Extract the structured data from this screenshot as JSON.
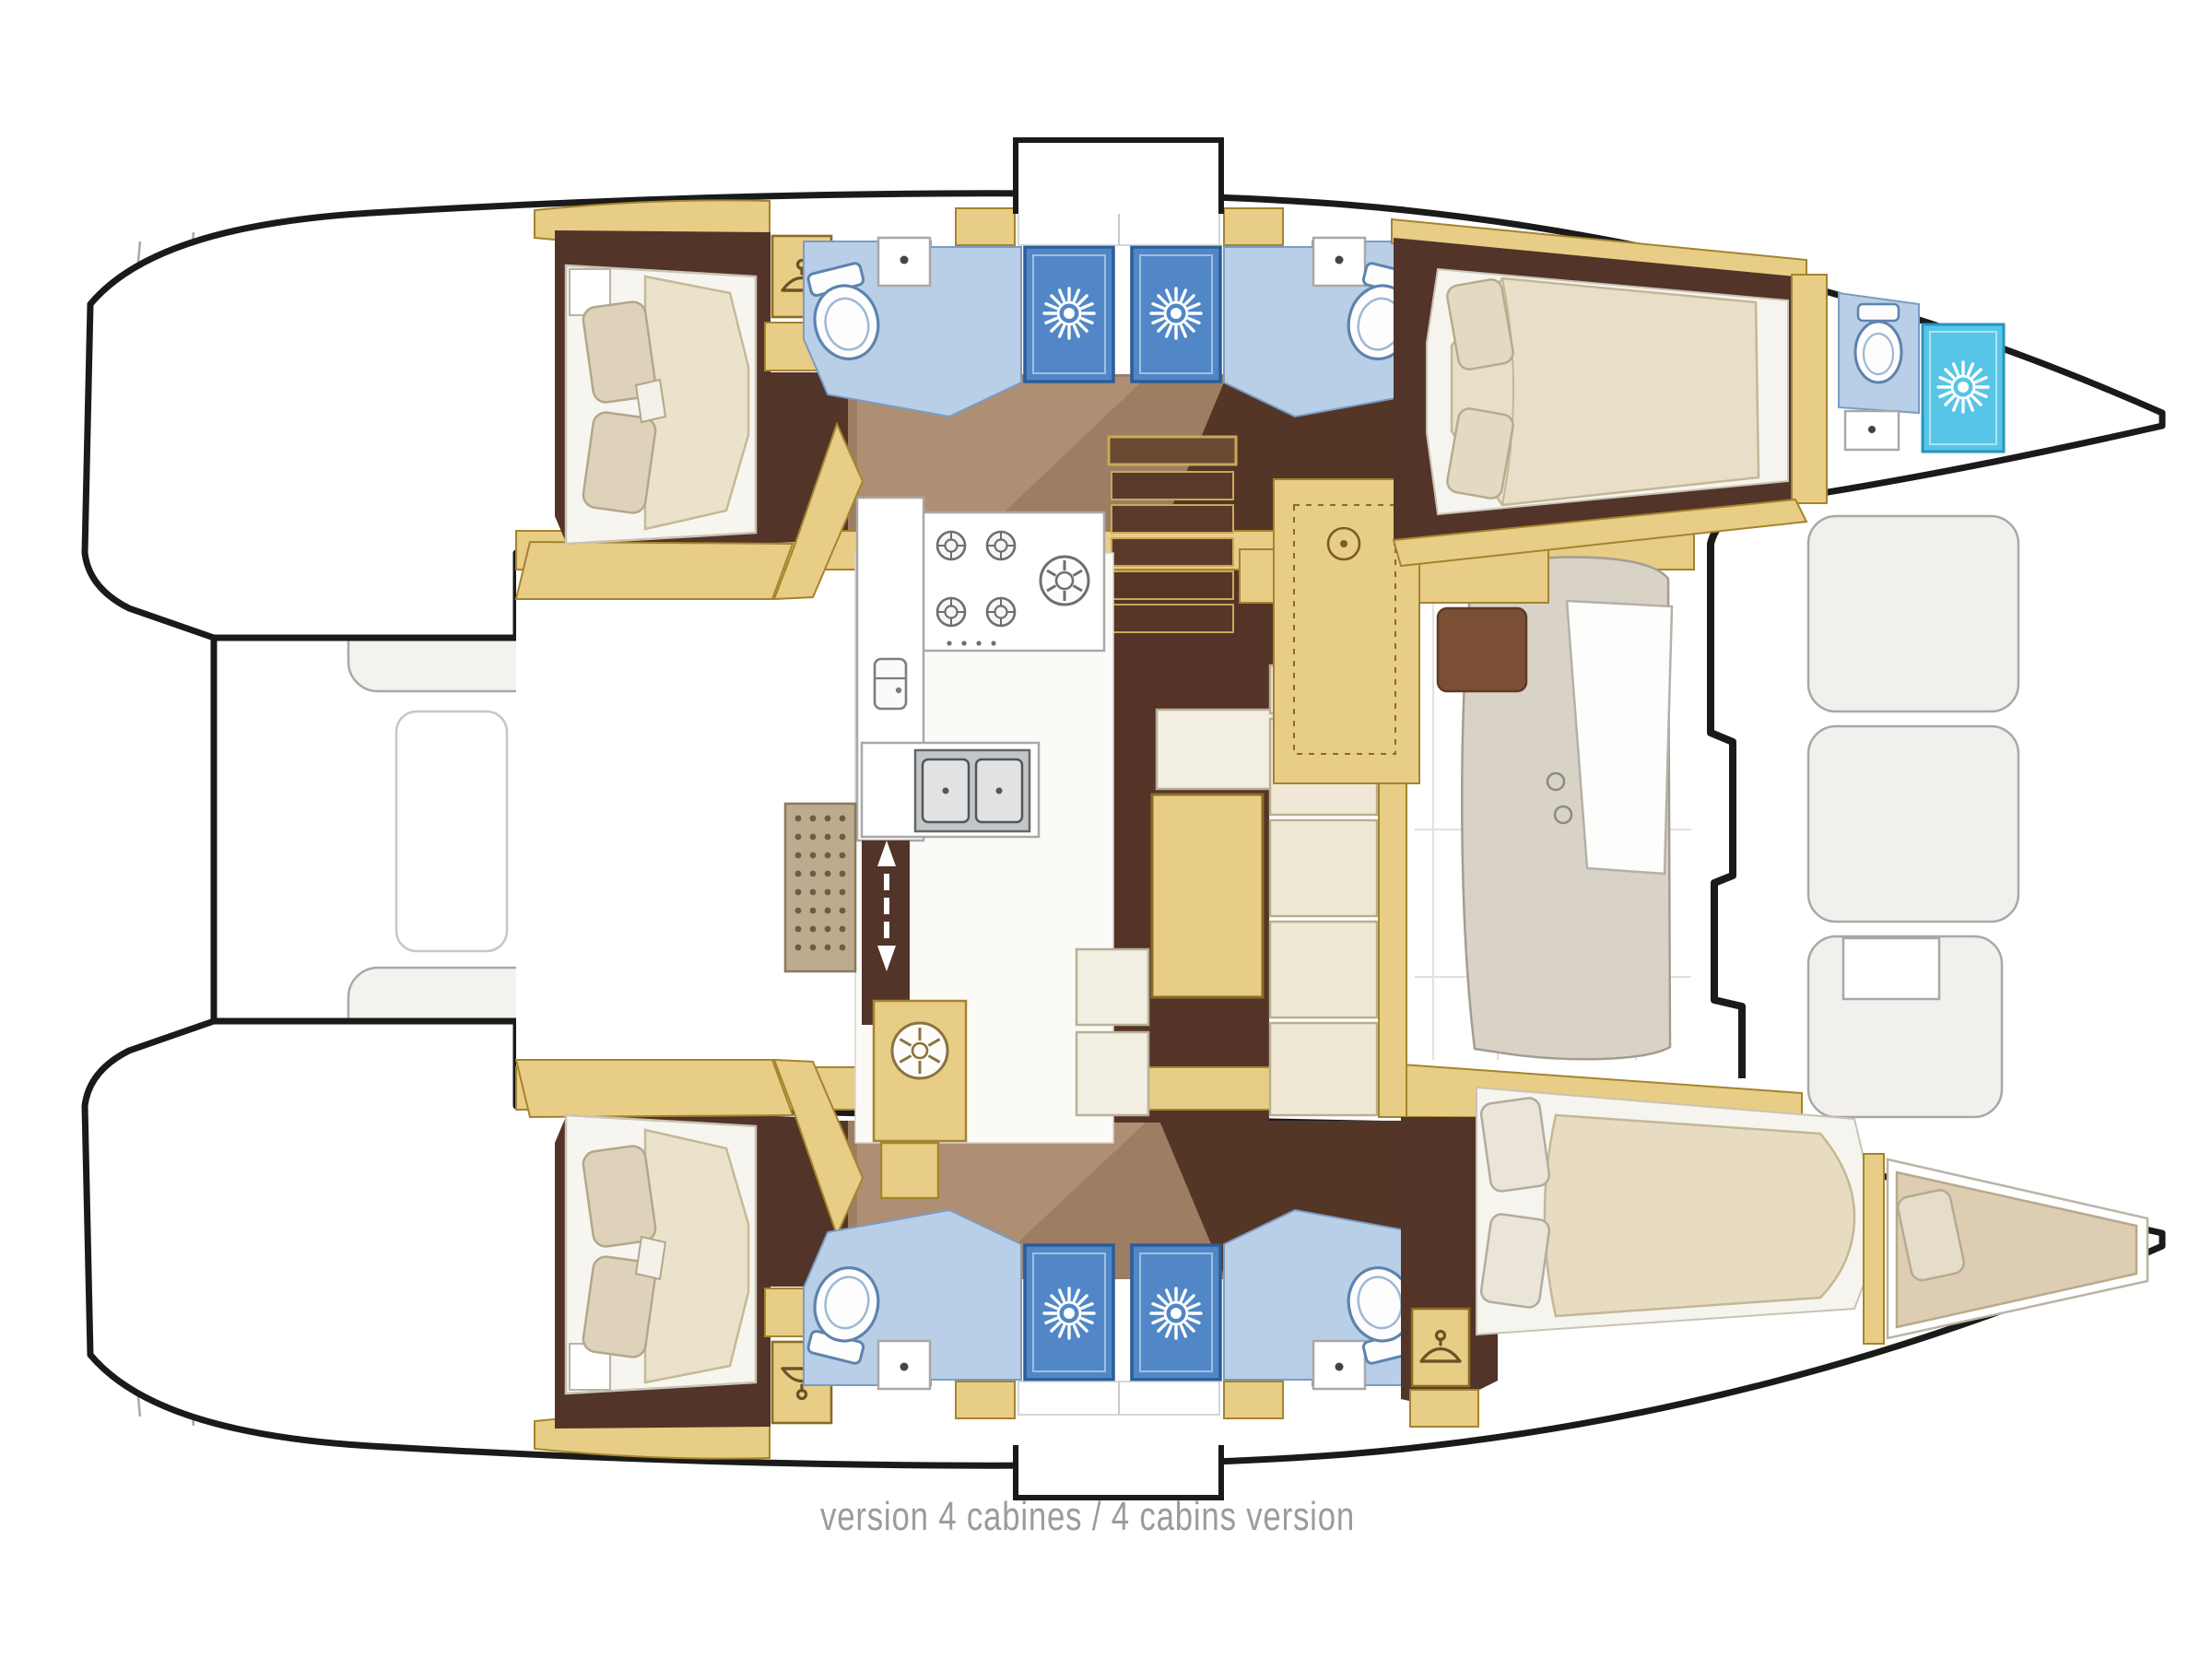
{
  "caption": {
    "text": "version 4 cabines / 4 cabins version"
  },
  "plan": {
    "type": "catamaran-floorplan",
    "cabins_shown": 4,
    "bathrooms_shown": 5,
    "shower_stalls_shown": 5
  },
  "palette": {
    "hull_outline": "#1a1a1a",
    "wood_tan": "#e8cd86",
    "wood_tan_edge": "#a5842e",
    "cabin_floor_dark_brown": "#523428",
    "walkway_brown": "#9d7e62",
    "walkway_brown_light": "#ae8f73",
    "mattress_cream": "#ebe2cb",
    "pillow_beige": "#ded3ba",
    "bathroom_floor_blue": "#b9cfe7",
    "shower_stall_blue": "#5187c6",
    "bow_shower_cyan": "#57c5e7",
    "deck_line_gray": "#a8a8a8",
    "bench_greige": "#d9d2c7",
    "caption_gray": "#9b9b9b"
  },
  "icons": {
    "hanger-icon": "clothes hanger (wardrobe)",
    "shower-icon": "starburst spray head",
    "toilet-icon": "toilet top view",
    "burner-icon": "gas ring",
    "big-burner-icon": "large gas ring",
    "fan-icon": "spoked vent",
    "fridge-icon": "refrigerator",
    "sink-icon": "basin with faucet dot",
    "updown-arrow-icon": "companionway double arrow"
  }
}
